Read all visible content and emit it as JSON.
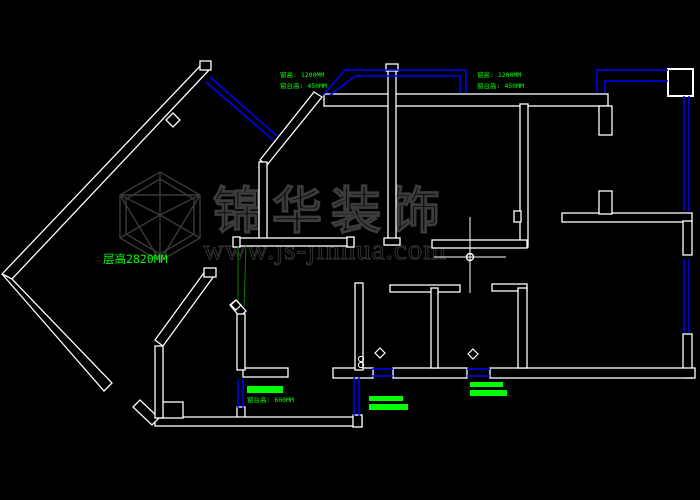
{
  "app": {
    "type": "cad-floorplan-viewer",
    "background_color": "#000000"
  },
  "colors": {
    "wall": "#ffffff",
    "window": "#0000ff",
    "annotation_green": "#00ff00",
    "annotation_dim_green": "#007d00",
    "watermark_gray": "#3a3a3a"
  },
  "annotations": {
    "window_label_left": {
      "line1": "窗高: 1200MM",
      "line2": "窗台高: 450MM"
    },
    "window_label_right": {
      "line1": "窗高: 1200MM",
      "line2": "窗台高: 450MM"
    },
    "ceiling_height_label": "层高2820MM",
    "sill_label_bottom": "窗台高: 600MM"
  },
  "watermark": {
    "brand": "锦华装饰",
    "website": "www.js-jinhua.com",
    "logo": "cube-wireframe-logo"
  }
}
